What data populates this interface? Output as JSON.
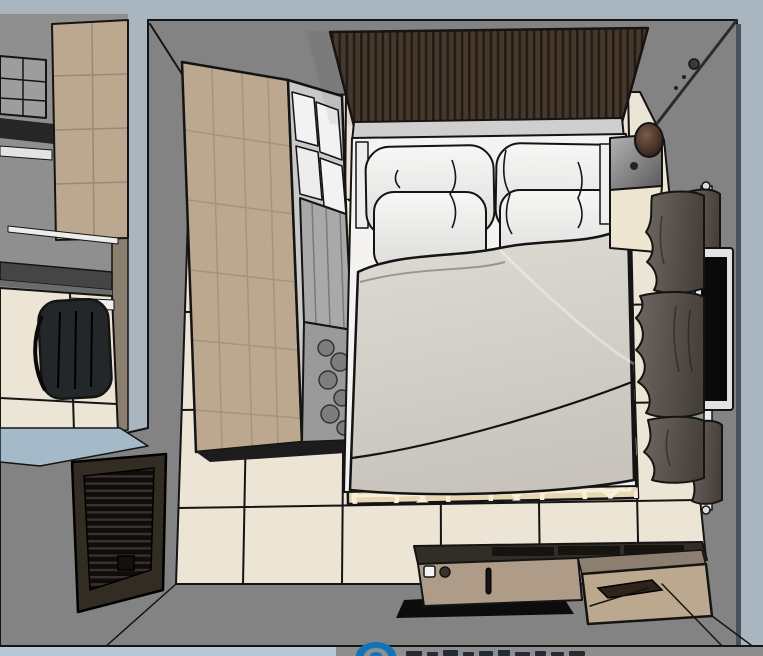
{
  "scene": {
    "view": "top-down-room-render",
    "objects": [
      "adjacent-room-wall",
      "adjacent-room-cabinet",
      "adjacent-room-shelf",
      "adjacent-room-desk",
      "office-chair",
      "adjacent-room-floor",
      "bedroom-walls",
      "tile-floor",
      "patterned-rug",
      "wardrobe",
      "wardrobe-glass-front",
      "hanging-clothes",
      "slatted-headboard-panel",
      "bed",
      "pillows",
      "duvet",
      "nightstand",
      "pendant-lamp",
      "lamp-cable",
      "window-frame",
      "curtains",
      "wall-tv",
      "low-console",
      "drawer-unit",
      "louvered-cabinet",
      "watermark-logo-partial"
    ]
  },
  "palette": {
    "bg": "#a9b6c0",
    "bgs": "#a5bac9",
    "bgbottom": "#b7c7d6",
    "wall": "#838383",
    "walledge": "#49525c",
    "wallbrown": "#8a7e6e",
    "tile": "#ece4d4",
    "rug": "#e7d7b2",
    "rugpat": "#f7f0dd",
    "woodlight": "#bba88f",
    "woodm": "#ae9b88",
    "panel": "#46382c",
    "panelline": "#241c14",
    "headtop": "#cfcfcf",
    "mattress": "#f4f3f1",
    "duvetlight": "#dedbd4",
    "duvetdark": "#c8c4bd",
    "pillowlight": "#f7f7f6",
    "pillowdark": "#dcdbd8",
    "curtainlight": "#6e6660",
    "curtaindark": "#474039",
    "chrome": "#e2e2e2",
    "screen": "#0a0a0a",
    "chair": "#23272a",
    "desk": "#454545",
    "cream": "#efe6d2",
    "ctop": "#332d27",
    "shadowblack": "#0c0c0c",
    "louverframe": "#332c23",
    "louverdark": "#0f0d0b",
    "louverline": "#39312a",
    "glass": "#9aa294",
    "plant": "#3f5a33",
    "lamplight": "#7a5a48",
    "lampdark": "#241813",
    "grayshelf": "#9d9d9d",
    "slab": "#262626",
    "white": "#f2f2f2",
    "bottomgray": "#8e8e8e",
    "wmblue": "#1173b8",
    "wmtext": "#252b33",
    "outline": "#141414"
  },
  "watermark": {
    "icon": "partial-logo-arc",
    "note_glyphs_cut_off": true
  }
}
